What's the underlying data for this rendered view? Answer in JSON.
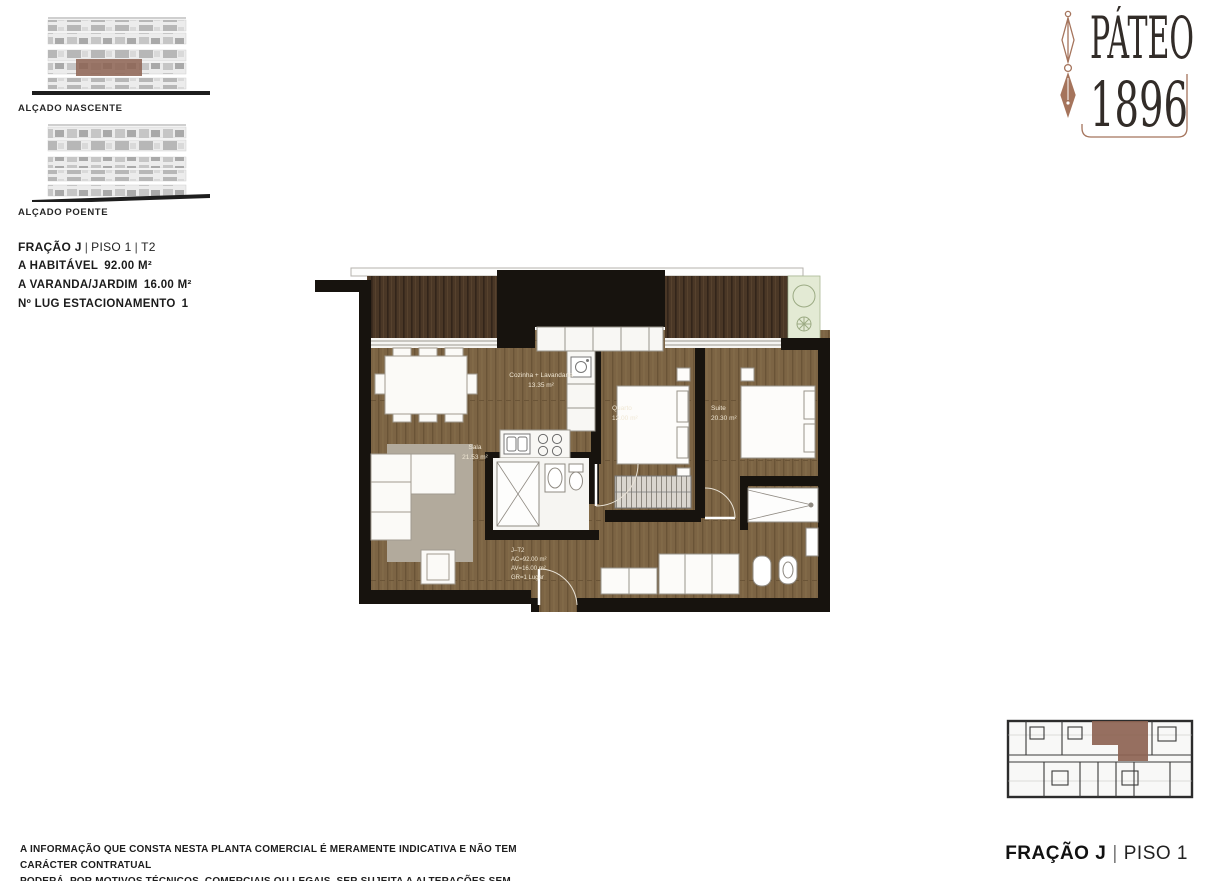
{
  "brand": {
    "name_line1": "PÁTEO",
    "name_line2": "1896",
    "accent_color": "#a5745c",
    "text_color": "#322c28"
  },
  "elevations": [
    {
      "label": "ALÇADO NASCENTE",
      "highlighted": true
    },
    {
      "label": "ALÇADO POENTE",
      "highlighted": false
    }
  ],
  "unit": {
    "fraction": "FRAÇÃO J",
    "floor": "PISO 1",
    "typology": "T2",
    "separator": "|",
    "stats": [
      {
        "label": "A HABITÁVEL",
        "value": "92.00 M²"
      },
      {
        "label": "A VARANDA/JARDIM",
        "value": "16.00 M²"
      },
      {
        "label": "Nº LUG ESTACIONAMENTO",
        "value": "1"
      }
    ]
  },
  "floorplan": {
    "rooms": [
      {
        "id": "kitchen",
        "name": "Cozinha + Lavandaria",
        "area": "13.35 m²"
      },
      {
        "id": "living",
        "name": "Sala",
        "area": "21.53 m²"
      },
      {
        "id": "bedroom",
        "name": "Quarto",
        "area": "12.00 m²"
      },
      {
        "id": "suite",
        "name": "Suite",
        "area": "20.30 m²"
      }
    ],
    "unit_info": [
      "J–T2",
      "AC=92.00 m²",
      "AV=16.00 m²",
      "GR=1 Lugar"
    ],
    "colors": {
      "wall": "#17130e",
      "wood": "#7c6444",
      "deck": "#4a3726",
      "rug": "#b2aa9c",
      "planter": "#e3ead4",
      "highlight": "#8d6352"
    }
  },
  "keyplan": {
    "caption_fraction": "FRAÇÃO J",
    "caption_floor": "PISO 1",
    "highlight_color": "#8d6352"
  },
  "disclaimer": {
    "line1": "A INFORMAÇÃO QUE CONSTA NESTA PLANTA COMERCIAL É MERAMENTE INDICATIVA E NÃO TEM CARÁCTER CONTRATUAL",
    "line2": "PODERÁ, POR MOTIVOS TÉCNICOS, COMERCIAIS OU LEGAIS, SER SUJEITA A ALTERAÇÕES SEM AVISO PRÉVIO"
  }
}
